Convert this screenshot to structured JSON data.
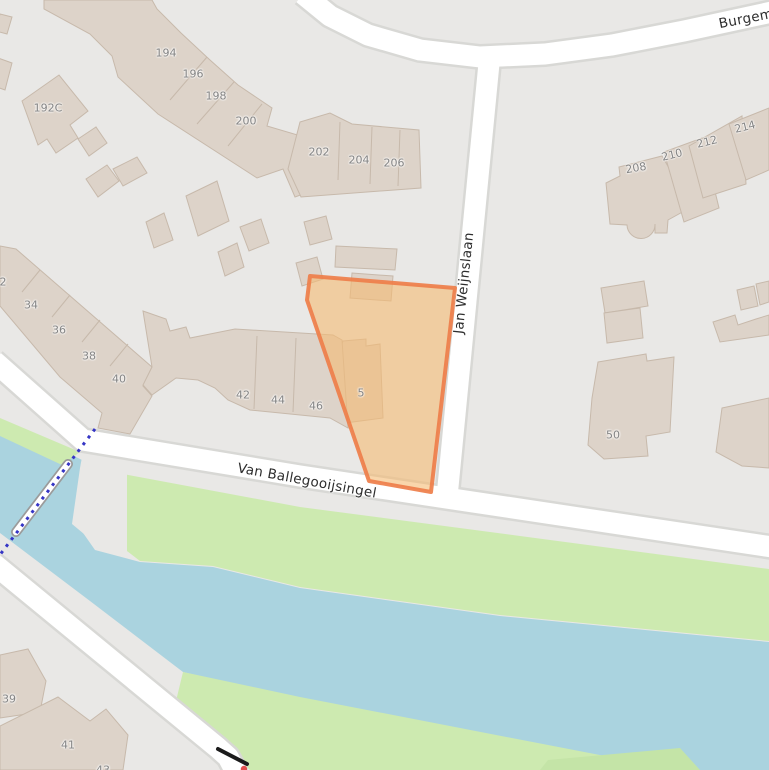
{
  "map": {
    "streets": [
      {
        "id": "jan-weijnslaan",
        "text": "Jan Weijnslaan"
      },
      {
        "id": "van-ballegooijsingel",
        "text": "Van Ballegooijsingel"
      },
      {
        "id": "burgemeester",
        "text": "Burgem"
      }
    ],
    "house_numbers": [
      {
        "text": "194"
      },
      {
        "text": "196"
      },
      {
        "text": "198"
      },
      {
        "text": "200"
      },
      {
        "text": "202"
      },
      {
        "text": "204"
      },
      {
        "text": "206"
      },
      {
        "text": "192C"
      },
      {
        "text": "208"
      },
      {
        "text": "210"
      },
      {
        "text": "212"
      },
      {
        "text": "214"
      },
      {
        "text": "2"
      },
      {
        "text": "34"
      },
      {
        "text": "36"
      },
      {
        "text": "38"
      },
      {
        "text": "40"
      },
      {
        "text": "42"
      },
      {
        "text": "44"
      },
      {
        "text": "46"
      },
      {
        "text": "5"
      },
      {
        "text": "50"
      },
      {
        "text": "39"
      },
      {
        "text": "41"
      },
      {
        "text": "43"
      }
    ],
    "selection": {
      "kind": "highlighted-parcel",
      "fill": "#f5bb73",
      "stroke": "#ee7e4a"
    },
    "colors": {
      "land": "#e9e8e6",
      "water": "#aad3df",
      "grass": "#cdeab0",
      "grass_dark": "#c4e4a7",
      "building": "#ddd3c9",
      "building_border": "#c7b9ab",
      "road": "#ffffff",
      "road_casing": "#d8d8d5",
      "path_dots": "#3535c5",
      "house_number_text": "#838383",
      "street_text": "#2e2e2e"
    }
  }
}
